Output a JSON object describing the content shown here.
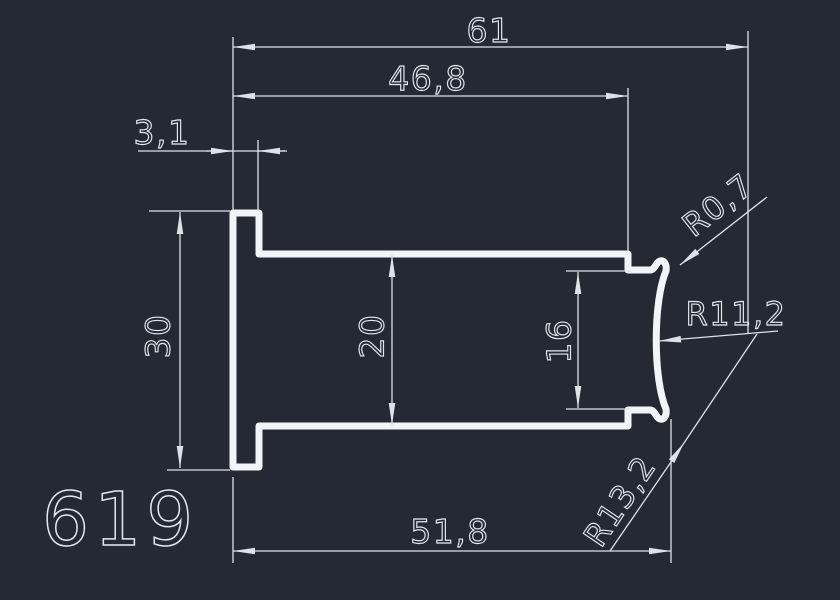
{
  "drawing": {
    "part_number": "619",
    "type": "profile-cross-section",
    "colors": {
      "background": "#242933",
      "profile_line": "#f2f5f8",
      "dimension_line": "#dde2e8",
      "text": "#e3e7ec"
    },
    "dims": {
      "total_width": {
        "label": "61"
      },
      "upper_width": {
        "label": "46,8"
      },
      "flange_thickness": {
        "label": "3,1"
      },
      "flange_height": {
        "label": "30"
      },
      "web_height": {
        "label": "20"
      },
      "tip_height": {
        "label": "16"
      },
      "body_length": {
        "label": "51,8"
      },
      "radius_small": {
        "label": "R0,7"
      },
      "radius_concave": {
        "label": "R11,2"
      },
      "radius_corner": {
        "label": "R13,2"
      }
    }
  }
}
